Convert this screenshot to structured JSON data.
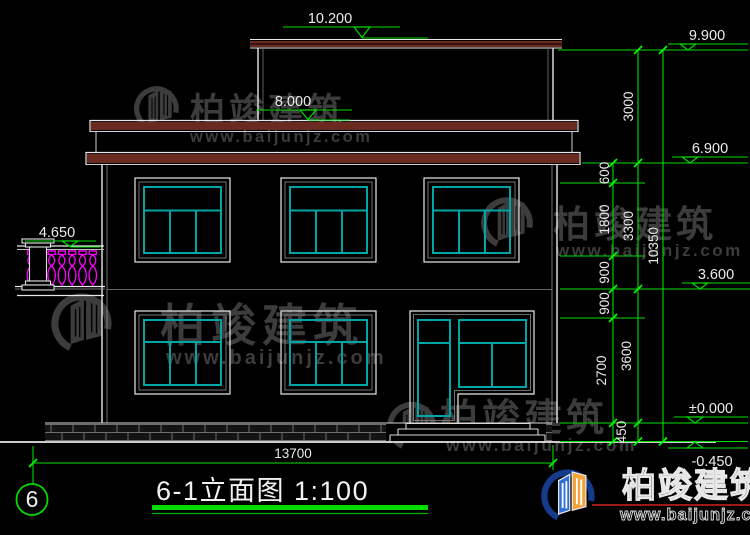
{
  "sheet": {
    "number": "6",
    "title": "6-1立面图 1:100"
  },
  "levels_left": [
    {
      "value": "10.200"
    },
    {
      "value": "8.000"
    },
    {
      "value": "4.650"
    }
  ],
  "levels_right": [
    {
      "value": "9.900"
    },
    {
      "value": "6.900"
    },
    {
      "value": "3.600"
    },
    {
      "value": "±0.000"
    },
    {
      "value": "-0.450"
    }
  ],
  "dims": {
    "inner": [
      "600",
      "1800",
      "900",
      "900",
      "2700",
      "450"
    ],
    "mid": [
      "3000",
      "3300",
      "3600"
    ],
    "overall_height": "10350",
    "overall_width": "13700"
  },
  "watermark": {
    "brand": "柏竣建筑",
    "url": "www.baijunjz.com"
  },
  "footer_logo": {
    "brand": "柏竣建筑",
    "url": "www.baijunjz.com"
  }
}
